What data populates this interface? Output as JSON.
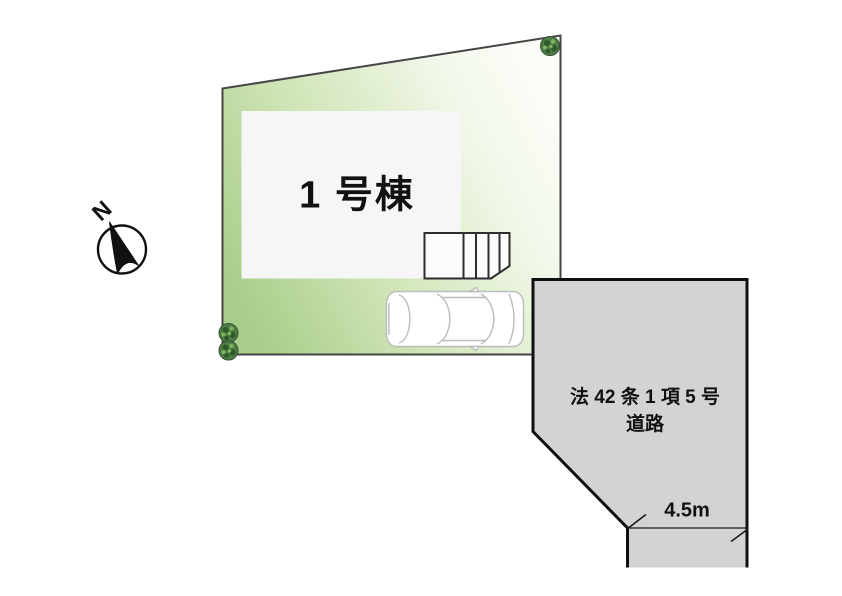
{
  "diagram": {
    "kind": "real-estate site plan",
    "compass": {
      "label": "N"
    },
    "plot": {
      "building_label": "1 号棟"
    },
    "road": {
      "name_line1": "法 42 条 1 項 5 号",
      "name_line2": "道路",
      "width_label": "4.5m"
    },
    "icons": {
      "compass": "compass-north-icon",
      "tree": "tree-icon",
      "car": "car-top-view-icon"
    },
    "colors": {
      "plot_green": "#a8cd8b",
      "plot_green_mid": "#cde3b3",
      "plot_fade": "#fbfdf8",
      "plot_border": "#454545",
      "building_fill": "#f6f6f6",
      "building_border": "#2d2d2d",
      "road_fill": "#d3d3d3",
      "road_border": "#0f0f0f",
      "tree_green": "#4e7d45",
      "tree_dark": "#2f5a2b",
      "tree_light": "#7fb35f",
      "car_stroke": "#bcbcbc",
      "text_color": "#111111"
    }
  }
}
